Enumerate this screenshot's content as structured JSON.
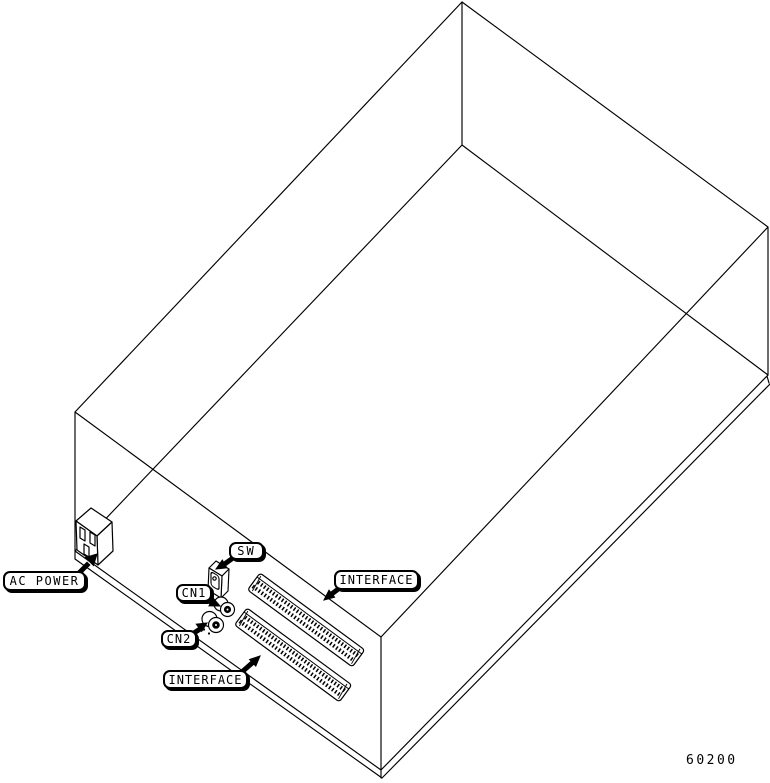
{
  "figure": {
    "id_number": "60200",
    "description": "Isometric wireframe drawing of equipment chassis rear panel",
    "colors": {
      "line": "#000000",
      "background": "#ffffff"
    },
    "callouts": {
      "ac_power": {
        "label": "AC POWER"
      },
      "sw": {
        "label": "SW"
      },
      "cn1": {
        "label": "CN1"
      },
      "cn2": {
        "label": "CN2"
      },
      "interface_upper": {
        "label": "INTERFACE"
      },
      "interface_lower": {
        "label": "INTERFACE"
      }
    }
  }
}
